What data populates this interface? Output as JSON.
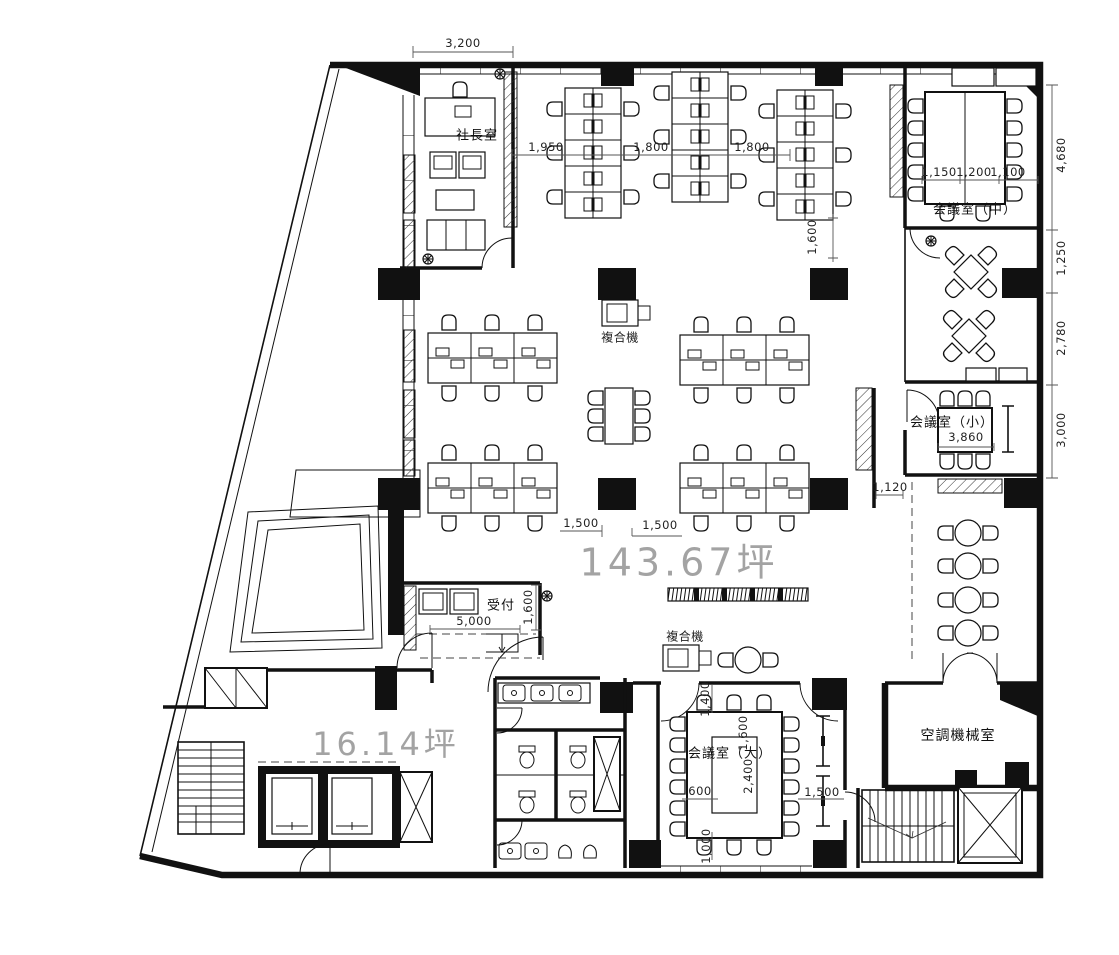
{
  "plan": {
    "rooms": {
      "president": "社長室",
      "meeting_m": "会議室（中）",
      "meeting_s": "会議室（小）",
      "meeting_l": "会議室（大）",
      "hvac": "空調機械室",
      "reception": "受付",
      "copier_mid": "複合機",
      "copier_south": "複合機"
    },
    "areas": {
      "office": "143.67坪",
      "core": "16.14坪"
    },
    "dims": {
      "top_president": "3,200",
      "desk_1": "1,950",
      "desk_2": "1,800",
      "desk_3": "1,800",
      "desk_v": "1,600",
      "mtg_m_1": "1,150",
      "mtg_m_2": "1,200",
      "mtg_m_3": "1,100",
      "right_1": "4,680",
      "right_2": "1,250",
      "right_3": "2,780",
      "right_4": "3,000",
      "mtg_s_w": "3,860",
      "locker": "1,120",
      "mid_1": "1,500",
      "mid_2": "1,500",
      "reception_w": "5,000",
      "reception_d": "1,600",
      "mtg_l_top": "1,400",
      "mtg_l_w": "1,600",
      "mtg_l_d": "2,400",
      "mtg_l_600": "600",
      "mtg_l_side": "1,500",
      "mtg_l_bottom": "1,000"
    }
  }
}
